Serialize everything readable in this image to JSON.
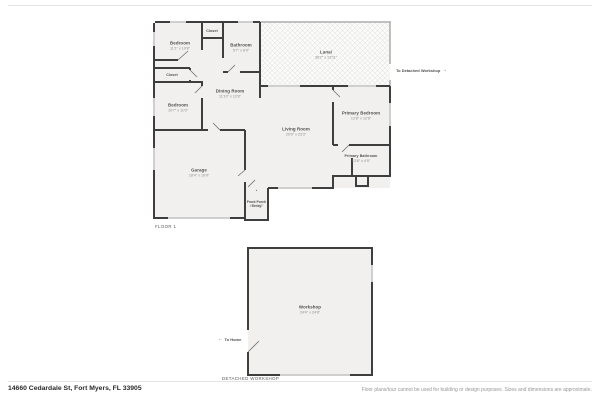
{
  "colors": {
    "wall": "#3e3e3e",
    "screen_wall": "#ababab",
    "floor_fill": "#f1f0ee",
    "window": "#cfcfcf"
  },
  "icons": {
    "exit_right": "→",
    "exit_left": "←",
    "entry_marker": "▴"
  },
  "floor1": {
    "plan_label": "FLOOR 1",
    "to_workshop_label": "To Detached Workshop",
    "rooms": {
      "bedroom1": {
        "name": "Bedroom",
        "dims": "11'1\" x 10'8\""
      },
      "closet_top": {
        "name": "Closet"
      },
      "bathroom": {
        "name": "Bathroom",
        "dims": "5'7\" x 8'9\""
      },
      "lanai": {
        "name": "Lanai",
        "dims": "38'2\" x 13'11\""
      },
      "closet_left": {
        "name": "Closet"
      },
      "dining_room": {
        "name": "Dining Room",
        "dims": "11'10\" x 12'8\""
      },
      "bedroom2": {
        "name": "Bedroom",
        "dims": "10'7\" x 11'0\""
      },
      "living_room": {
        "name": "Living Room",
        "dims": "20'9\" x 23'3\""
      },
      "primary_bedroom": {
        "name": "Primary Bedroom",
        "dims": "13'8\" x 12'8\""
      },
      "primary_bathroom": {
        "name": "Primary Bathroom",
        "dims": "13'8\" x 4'9\""
      },
      "garage": {
        "name": "Garage",
        "dims": "18'4\" x 19'9\""
      },
      "entry": {
        "name": "Entry"
      },
      "front_porch": {
        "name": "Front Porch",
        "dims": "4'6\" x 6'9\""
      }
    }
  },
  "workshop_plan": {
    "plan_label": "DETACHED WORKSHOP",
    "to_home_label": "To Home",
    "rooms": {
      "workshop": {
        "name": "Workshop",
        "dims": "24'4\" x 24'8\""
      }
    }
  },
  "footer": {
    "address": "14660 Cedardale St, Fort Myers, FL 33905",
    "disclaimer": "Floor plans/tour cannot be used for building or design purposes. Sizes and dimensions are approximate."
  }
}
